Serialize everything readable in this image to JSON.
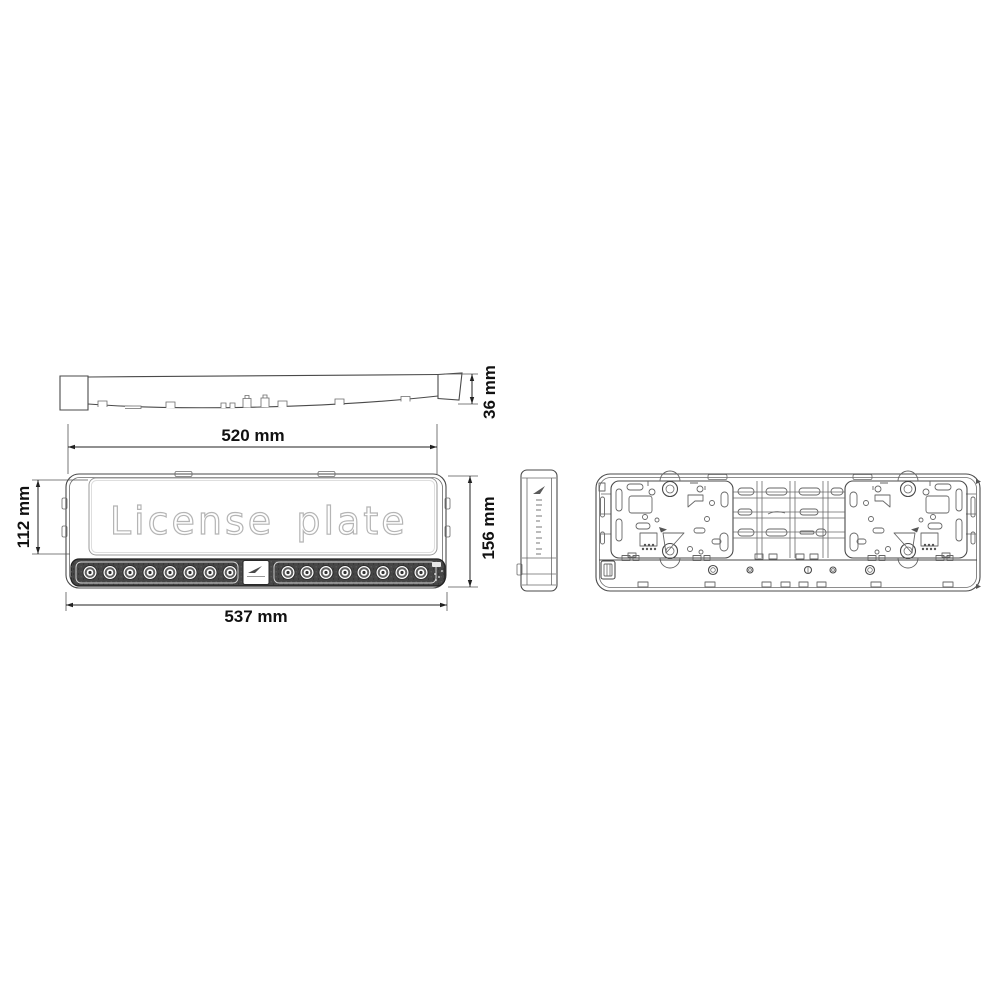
{
  "drawing": {
    "plate_text": "License plate",
    "plate_text_word1": "License",
    "plate_text_word2": "plate",
    "views": {
      "top_profile": "top-profile-view",
      "front": "front-view",
      "side": "side-view",
      "rear": "rear-view"
    },
    "front": {
      "led_count_left": 8,
      "led_count_right": 8,
      "led_total": 16,
      "center_badge_icon": "brand-swoosh-icon"
    },
    "dimensions": {
      "inner_width": "520 mm",
      "thickness": "36 mm",
      "plate_height": "112 mm",
      "total_height": "156 mm",
      "total_width": "537 mm"
    },
    "colors": {
      "background": "#ffffff",
      "line": "#4a4a4a",
      "dimension_text": "#111111",
      "plate_text_outline": "#b5b5b5",
      "led_strip_fill": "#464646"
    }
  }
}
